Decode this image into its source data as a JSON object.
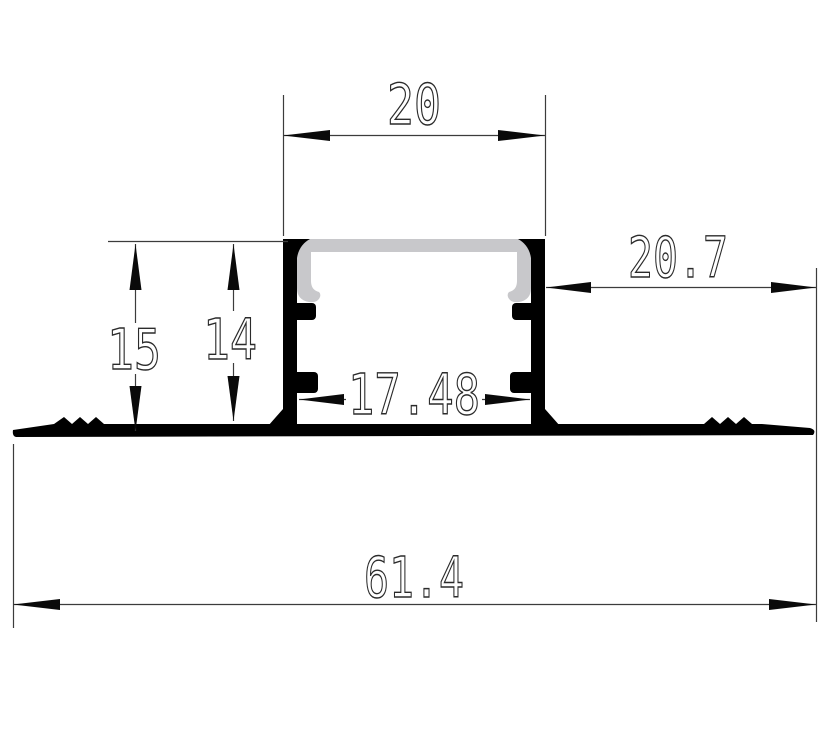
{
  "drawing": {
    "description": "Technical 2D cross-section drawing of a trimless recessed LED aluminium profile with plaster-in flanges and a grey diffuser cover",
    "colors": {
      "profile_outline": "#000000",
      "diffuser_cover": "#c8c8cb",
      "dimension_lines": "#3c3c3c",
      "background": "#ffffff"
    },
    "dimensions": {
      "top_width": "20",
      "left_height_outer": "15",
      "left_height_inner": "14",
      "inner_width": "17.48",
      "right_flange_width": "20.7",
      "total_width": "61.4"
    }
  }
}
